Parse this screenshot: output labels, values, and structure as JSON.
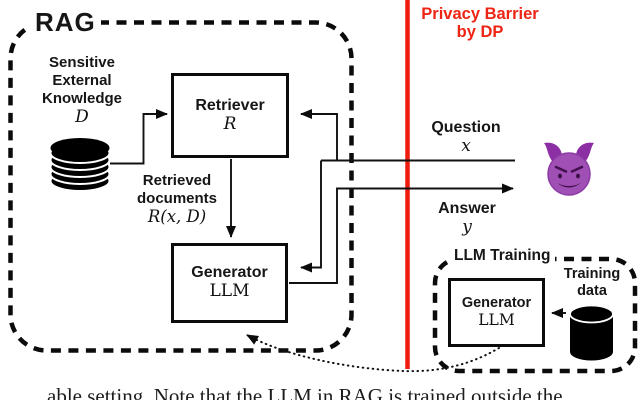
{
  "rag": {
    "label": "RAG"
  },
  "privacy_barrier": {
    "line1": "Privacy Barrier",
    "line2": "by DP",
    "color": "#ee2414",
    "line_color": "#ef1b0e"
  },
  "knowledge": {
    "line1": "Sensitive",
    "line2": "External",
    "line3": "Knowledge",
    "symbol": "D"
  },
  "retriever": {
    "name": "Retriever",
    "symbol": "R"
  },
  "retrieved_docs": {
    "line1": "Retrieved",
    "line2": "documents",
    "formula": "R(x, D)"
  },
  "generator": {
    "name": "Generator",
    "symbol": "LLM"
  },
  "question": {
    "label": "Question",
    "symbol": "x"
  },
  "answer": {
    "label": "Answer",
    "symbol": "y"
  },
  "llm_training": {
    "label": "LLM Training"
  },
  "training_generator": {
    "name": "Generator",
    "symbol": "LLM"
  },
  "training_data": {
    "line1": "Training",
    "line2": "data"
  },
  "icons": {
    "attacker": "smiling-devil-emoji",
    "knowledge_db": "database-stack-icon",
    "training_db": "database-cylinder-icon",
    "devil_color": "#a04fb5"
  },
  "caption": {
    "fragment": "able setting. Note that the LLM in RAG is trained outside the"
  }
}
